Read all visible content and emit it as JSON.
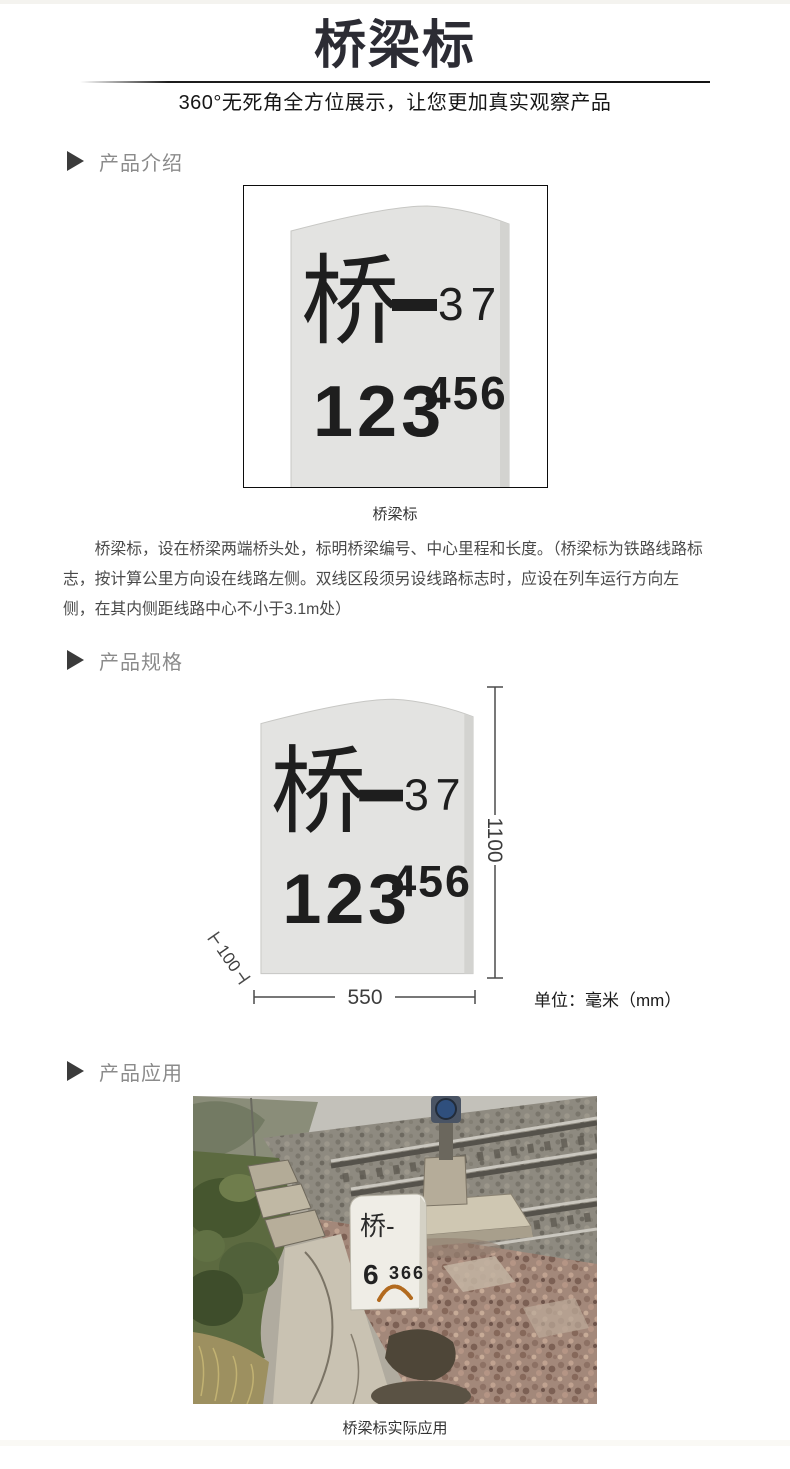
{
  "header": {
    "title": "桥梁标",
    "subtitle": "360°无死角全方位展示，让您更加真实观察产品"
  },
  "sections": {
    "intro": {
      "title": "产品介绍",
      "image_caption": "桥梁标",
      "description": "桥梁标，设在桥梁两端桥头处，标明桥梁编号、中心里程和长度。（桥梁标为铁路线路标志，按计算公里方向设在线路左侧。双线区段须另设线路标志时，应设在列车运行方向左侧，在其内侧距线路中心不小于3.1m处）"
    },
    "spec": {
      "title": "产品规格",
      "dimensions": {
        "height_mm": "1100",
        "width_mm": "550",
        "depth_mm": "100",
        "unit_label": "单位：毫米（mm）"
      }
    },
    "application": {
      "title": "产品应用",
      "image_caption": "桥梁标实际应用",
      "photo_marker": {
        "line1": "桥-",
        "number_main": "6",
        "number_sub": "366"
      }
    }
  },
  "stone_marker": {
    "character": "桥",
    "number": "37",
    "mileage_main": "123",
    "mileage_sup": "456"
  },
  "colors": {
    "title_dark": "#2c2c34",
    "section_gray": "#8b8b8b",
    "stone_gray": "#e3e3e1",
    "stone_text": "#1e1e1e"
  }
}
